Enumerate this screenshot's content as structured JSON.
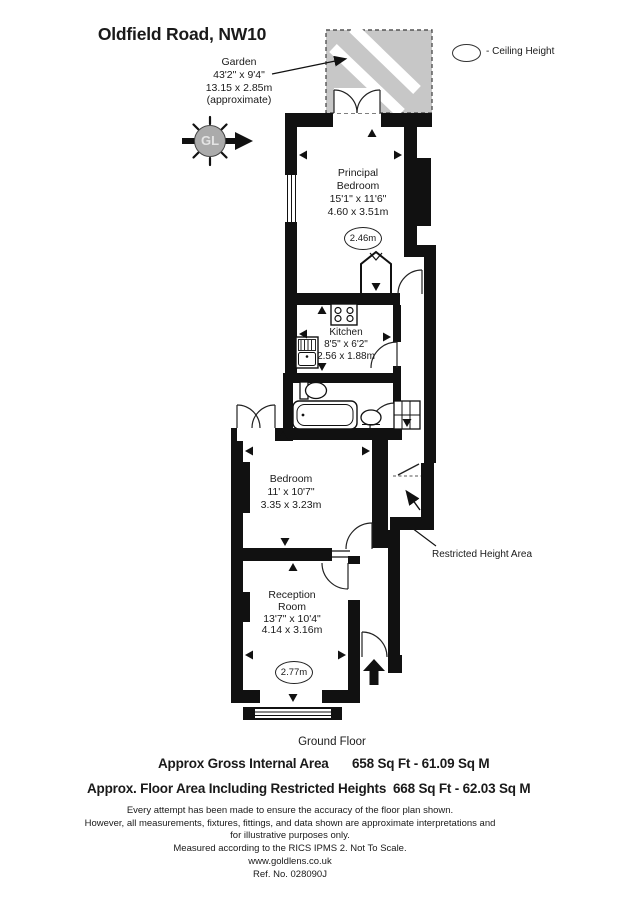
{
  "title": "Oldfield Road, NW10",
  "garden": {
    "label": "Garden",
    "imperial": "43'2\" x 9'4\"",
    "metric": "13.15 x 2.85m",
    "note": "(approximate)"
  },
  "legend": {
    "ceiling_height": "- Ceiling Height"
  },
  "compass": {
    "initials": "GL"
  },
  "rooms": {
    "principal_bedroom": {
      "line1": "Principal",
      "line2": "Bedroom",
      "imperial": "15'1\" x 11'6\"",
      "metric": "4.60 x 3.51m",
      "ceiling_height": "2.46m"
    },
    "kitchen": {
      "label": "Kitchen",
      "imperial": "8'5\" x 6'2\"",
      "metric": "2.56 x 1.88m"
    },
    "bedroom": {
      "label": "Bedroom",
      "imperial": "11' x 10'7\"",
      "metric": "3.35 x 3.23m"
    },
    "reception_room": {
      "line1": "Reception",
      "line2": "Room",
      "imperial": "13'7\" x 10'4\"",
      "metric": "4.14 x 3.16m",
      "ceiling_height": "2.77m"
    }
  },
  "annotations": {
    "restricted_height_area": "Restricted Height Area"
  },
  "footer": {
    "floor_label": "Ground Floor",
    "areas": [
      {
        "label": "Approx Gross Internal Area",
        "value": "658 Sq Ft - 61.09 Sq M"
      },
      {
        "label": "Approx. Floor Area Including Restricted Heights",
        "value": "668 Sq Ft - 62.03 Sq M"
      }
    ],
    "disclaimer": [
      "Every attempt has been made to ensure the accuracy of the floor plan shown.",
      "However, all measurements, fixtures, fittings, and data shown are approximate interpretations and",
      "for illustrative purposes only.",
      "Measured according to the RICS IPMS 2. Not To Scale."
    ],
    "website": "www.goldlens.co.uk",
    "reference": "Ref. No. 028090J"
  },
  "colors": {
    "garden_fill": "#c7c7c7",
    "wall": "#111111",
    "compass_fill": "#ababab"
  }
}
